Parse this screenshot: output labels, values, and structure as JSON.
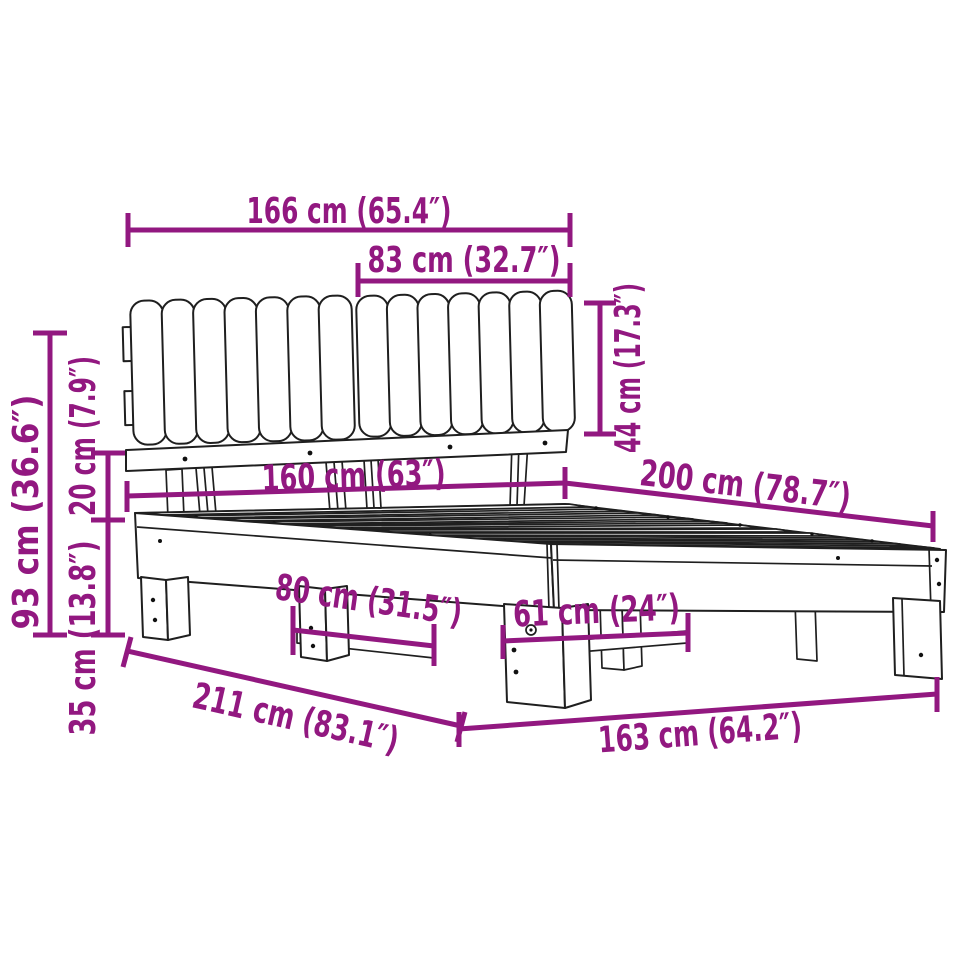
{
  "diagram": {
    "title": "bed-frame-dimension-diagram",
    "product": "bed frame with channel-tufted headboard",
    "accent_color": "#921880",
    "line_color": "#1f1f1f",
    "background_color": "#ffffff",
    "units": [
      "cm",
      "inches"
    ],
    "dimensions": [
      {
        "id": "headboard-total-width",
        "cm": 166,
        "inches": 65.4,
        "label": "166 cm (65.4″)"
      },
      {
        "id": "cushion-panel-width",
        "cm": 83,
        "inches": 32.7,
        "label": "83 cm (32.7″)"
      },
      {
        "id": "cushion-height",
        "cm": 44,
        "inches": 17.3,
        "label": "44 cm (17.3″)"
      },
      {
        "id": "headboard-height",
        "cm": 93,
        "inches": 36.6,
        "label": "93 cm (36.6″)"
      },
      {
        "id": "cushion-to-frame-gap",
        "cm": 20,
        "inches": 7.9,
        "label": "20 cm (7.9″)"
      },
      {
        "id": "frame-height",
        "cm": 35,
        "inches": 13.8,
        "label": "35 cm (13.8″)"
      },
      {
        "id": "bed-width",
        "cm": 160,
        "inches": 63,
        "label": "160 cm (63″)"
      },
      {
        "id": "bed-length",
        "cm": 200,
        "inches": 78.7,
        "label": "200 cm (78.7″)"
      },
      {
        "id": "leg-span-width",
        "cm": 80,
        "inches": 31.5,
        "label": "80 cm (31.5″)"
      },
      {
        "id": "leg-span-length",
        "cm": 61,
        "inches": 24,
        "label": "61 cm (24″)"
      },
      {
        "id": "overall-length",
        "cm": 211,
        "inches": 83.1,
        "label": "211 cm (83.1″)"
      },
      {
        "id": "base-length",
        "cm": 163,
        "inches": 64.2,
        "label": "163 cm (64.2″)"
      }
    ]
  }
}
